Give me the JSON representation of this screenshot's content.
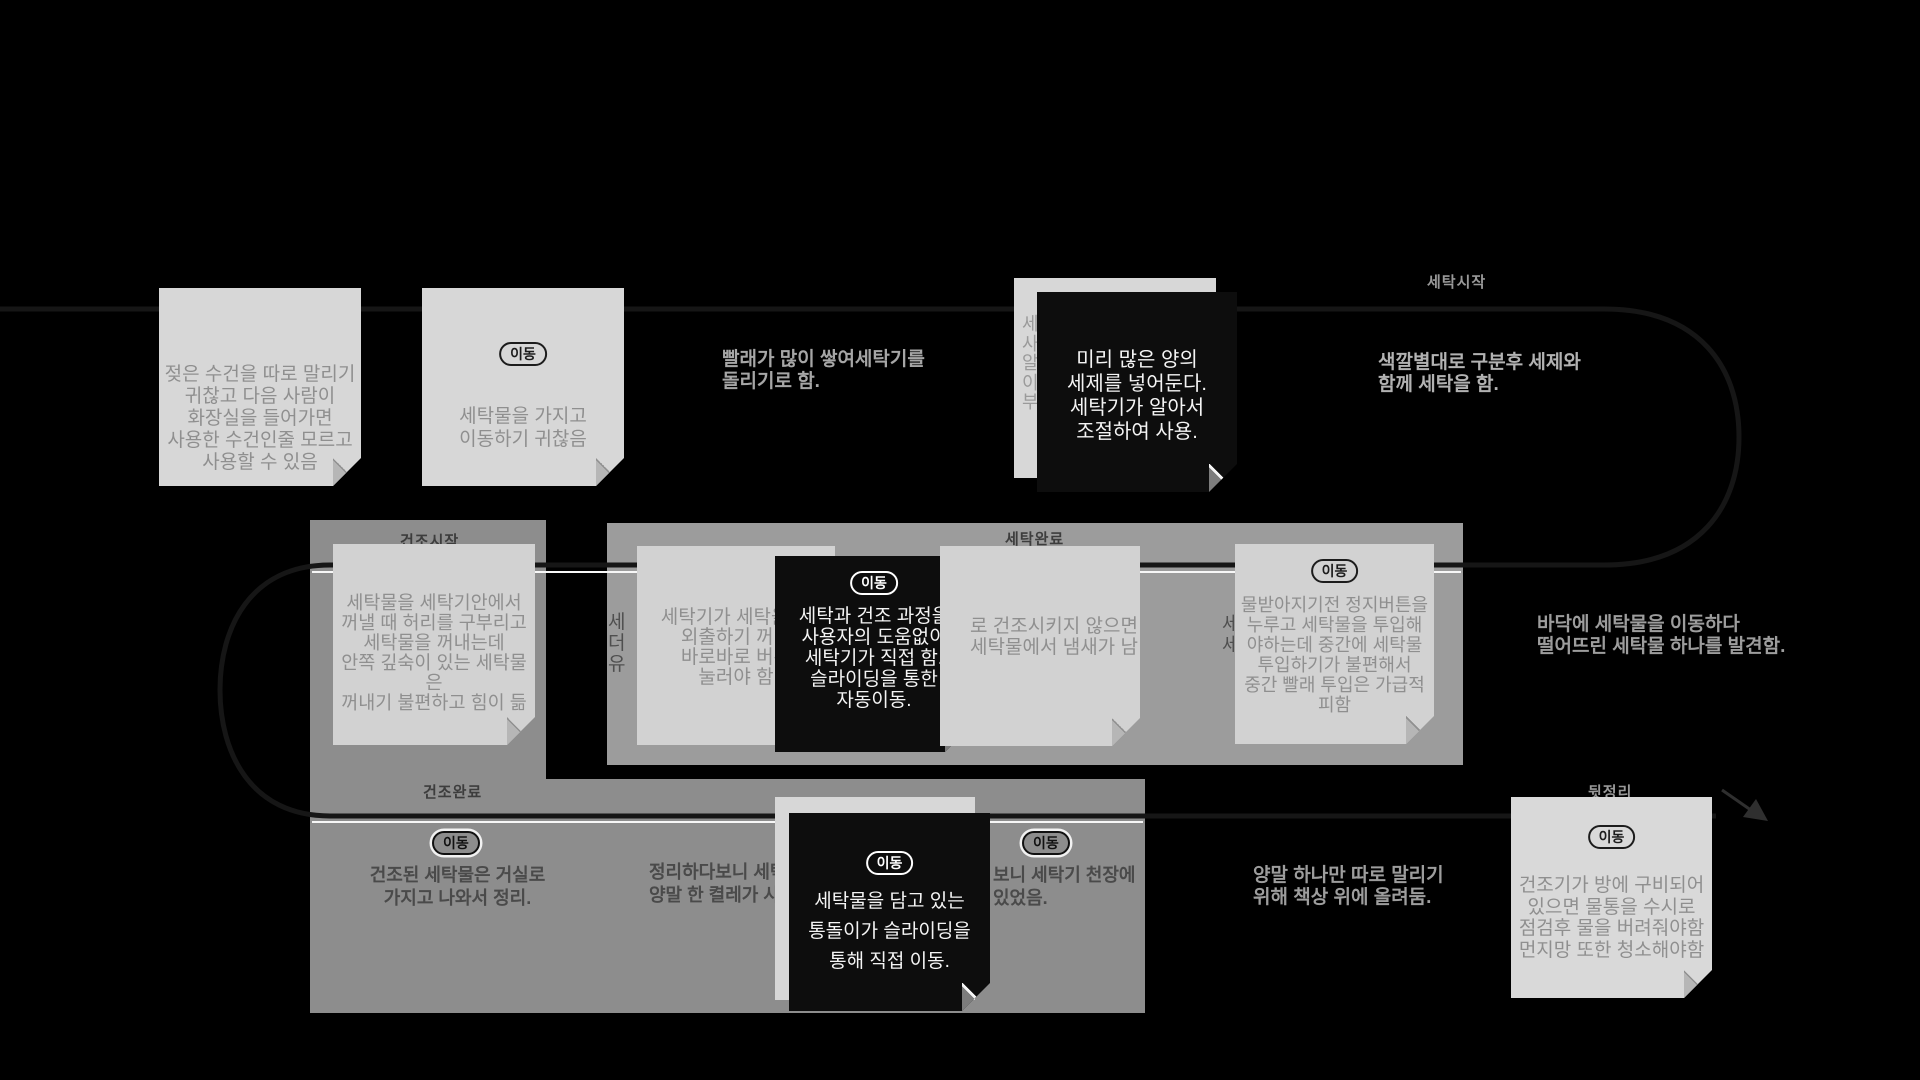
{
  "badge_label": "이동",
  "labels": {
    "wash_start": "세탁시작",
    "dry_start": "건조시작",
    "wash_done": "세탁완료",
    "dry_done": "건조완료",
    "cleanup": "뒷정리"
  },
  "annotations": {
    "piled_laundry": "빨래가 많이 쌓여세탁기를\n돌리기로 함.",
    "sort_by_color": "색깔별대로 구분후 세제와\n함께 세탁을 함.",
    "dropped_laundry": "바닥에 세탁물을 이동하다\n떨어뜨린 세탁물 하나를 발견함.",
    "single_sock": "양말 하나만 따로 말리기\n위해 책상 위에 올려둠."
  },
  "band_texts": {
    "carry_to_living_room": "건조된 세탁물은 거실로\n가지고 나와서 정리.",
    "tidy_partial_left": "정리하다보니 세탁\n양말 한 켤레가 사",
    "tidy_partial_right": "보니 세탁기 천장에\n있었음."
  },
  "fragments": {
    "hidden_note_top": "세\n사\n알\n이\n부",
    "inner_band_left": "세\n더\n유",
    "inner_band_mid": "세\n세"
  },
  "notes": {
    "wet_towel": {
      "text": "젖은 수건을 따로 말리기\n귀찮고 다음 사람이\n화장실을 들어가면\n사용한 수건인줄 모르고\n사용할 수 있음"
    },
    "carry_laundry": {
      "text": "세탁물을 가지고\n이동하기 귀찮음"
    },
    "detergent_auto": {
      "text": "미리 많은 양의\n세제를 넣어둔다.\n세탁기가 알아서\n조절하여 사용."
    },
    "bend_down": {
      "text": "세탁물을 세탁기안에서\n꺼낼 때 허리를 구부리고\n세탁물을 꺼내는데\n안쪽 깊숙이 있는 세탁물은\n꺼내기 불편하고 힘이 듦"
    },
    "press_buttons": {
      "text": "세탁기가 세탁을 해\n외출하기 꺼려\n바로바로 버튼\n눌러야 함"
    },
    "auto_wash_dry": {
      "text": "세탁과 건조 과정을\n사용자의 도움없이\n세탁기가 직접 함.\n슬라이딩을 통한\n자동이동."
    },
    "smell": {
      "text": "로 건조시키지 않으면\n세탁물에서 냄새가 남"
    },
    "mid_load": {
      "text": "물받아지기전 정지버튼을\n누루고 세탁물을 투입해\n야하는데 중간에 세탁물\n투입하기가 불편해서\n중간 빨래 투입은 가급적\n피함"
    },
    "tub_moves": {
      "text": "세탁물을 담고 있는\n통돌이가 슬라이딩을\n통해 직접 이동."
    },
    "dryer_water": {
      "text": "건조기가 방에 구비되어\n있으면 물통을 수시로\n점검후 물을 버려줘야함\n먼지망 또한 청소해야함"
    }
  },
  "colors": {
    "background": "#000000",
    "band": "#8d8d8d",
    "band_inner": "#9c9c9c",
    "note_light": "#d7d7d7",
    "note_dark": "#0d0d0d",
    "note_text_gray": "#8f8f8f",
    "annotation_text": "#a6a6a6",
    "band_text": "#4a4a4a",
    "path_line": "#161616"
  }
}
